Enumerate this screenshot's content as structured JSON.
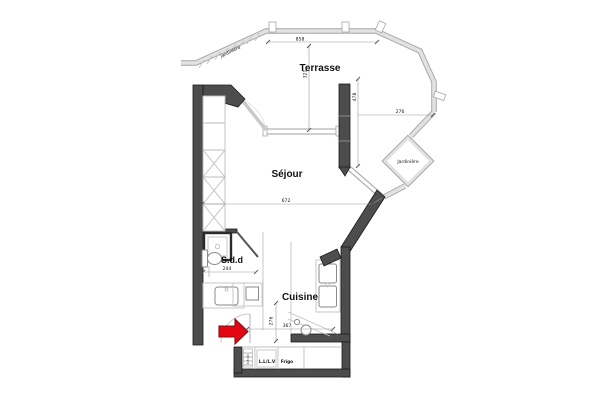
{
  "colors": {
    "wall_dark": "#4d4d4d",
    "wall_edge": "#1a1a1a",
    "wall_light": "#e2e2e2",
    "wall_light_edge": "#a6a6a6",
    "win": "#b3b3b3",
    "fixture": "#8a8a8a",
    "line_light": "#c2c2c2",
    "dim": "#9a9a9a",
    "text": "#111111",
    "accent_red": "#e30613",
    "accent_red_edge": "#7f1010"
  },
  "labels": {
    "terrasse": "Terrasse",
    "sejour": "Séjour",
    "cuisine": "Cuisine",
    "sdd": "S.d.d",
    "jardiniere_side": "Jardinière",
    "jardiniere_top": "Jardinière",
    "washer": "L.L/L.V",
    "fridge": "Frigo",
    "utility_strip": "t.e.d.t"
  },
  "dimensions": {
    "terrace_width": "858",
    "terrace_depth": "321",
    "bay_height": "478",
    "terrace_right_width": "276",
    "sejour_width": "672",
    "sdd_width": "244",
    "entry_depth": "276",
    "kitchen_width": "367"
  }
}
